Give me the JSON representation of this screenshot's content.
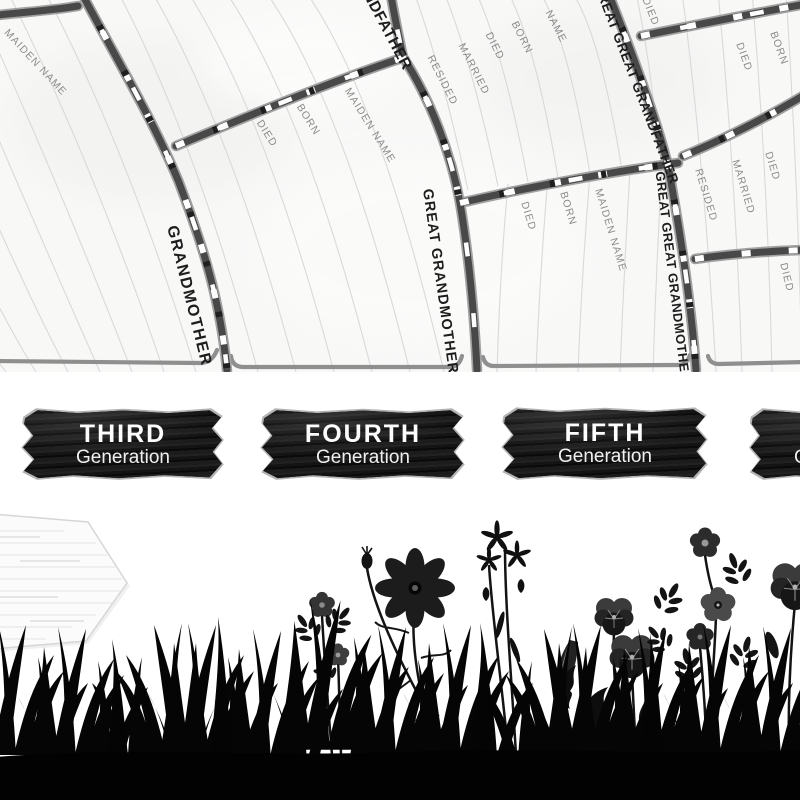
{
  "poster": {
    "fan_chart": {
      "spokes": [
        {
          "label": "GREAT GRANDFATHER"
        },
        {
          "label": "GRANDMOTHER"
        },
        {
          "label": "GREAT GRANDMOTHER"
        },
        {
          "label": "GREAT GREAT GRANDFATHER"
        },
        {
          "label": "GREAT GREAT GRANDMOTHER"
        }
      ],
      "field_labels": [
        {
          "text": "MAIDEN NAME"
        },
        {
          "text": "BORN"
        },
        {
          "text": "DIED"
        },
        {
          "text": "BORN"
        },
        {
          "text": "MAIDEN NAME"
        },
        {
          "text": "RESIDED"
        },
        {
          "text": "MARRIED"
        },
        {
          "text": "DIED"
        },
        {
          "text": "BORN"
        },
        {
          "text": "NAME"
        },
        {
          "text": "DIED"
        },
        {
          "text": "BORN"
        },
        {
          "text": "MAIDEN NAME"
        },
        {
          "text": "DIED"
        },
        {
          "text": "DIED"
        },
        {
          "text": "BORN"
        },
        {
          "text": "RESIDED"
        },
        {
          "text": "MARRIED"
        },
        {
          "text": "DIED"
        },
        {
          "text": "DIED"
        }
      ],
      "colors": {
        "background": "#f8f8f7",
        "rule_line": "#d9d9d9",
        "branch_dark": "#484848",
        "branch_light": "#a2a2a2",
        "wedge_edge": "#8f8f8f",
        "field_text": "#8b8b8b",
        "name_text": "#1d1d1d"
      }
    },
    "generation_signs": {
      "colors": {
        "wood": "#141414",
        "rim": "#b3b3b3",
        "text": "#fdfdfd"
      },
      "items": [
        {
          "line1": "THIRD",
          "line2": "Generation"
        },
        {
          "line1": "FOURTH",
          "line2": "Generation"
        },
        {
          "line1": "FIFTH",
          "line2": "Generation"
        },
        {
          "line1": "SIXTH",
          "line2": "Generation"
        }
      ]
    },
    "scene": {
      "colors": {
        "silhouette": "#0a0a0a",
        "arrow_sign_board": "#fbfbfb"
      }
    }
  }
}
